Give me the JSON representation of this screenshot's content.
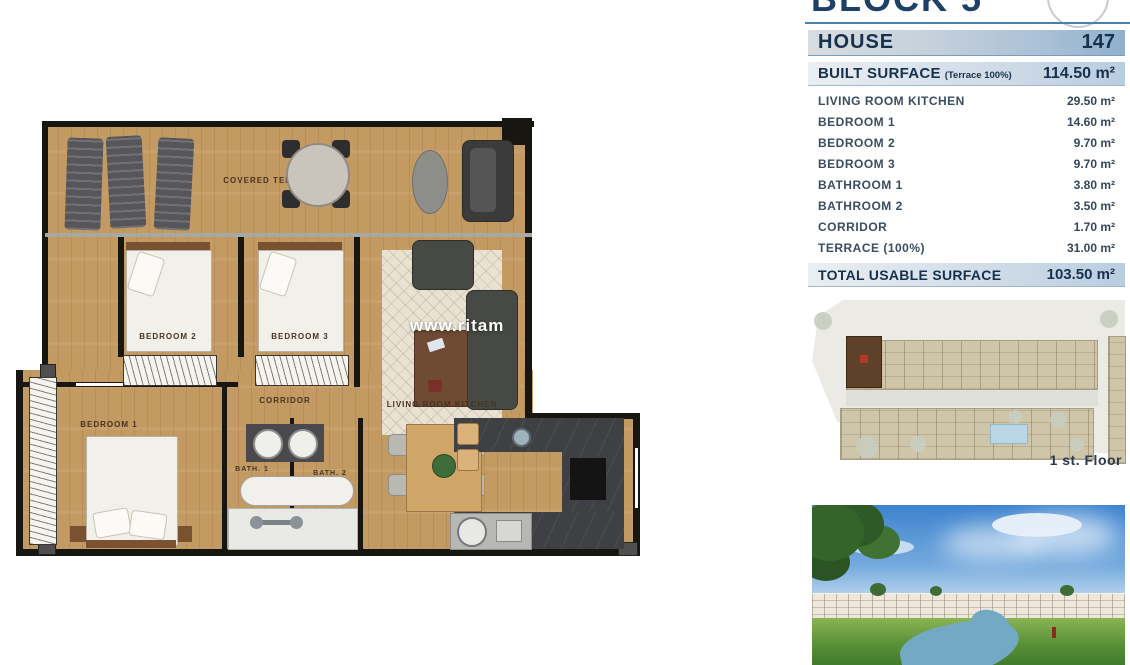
{
  "document": {
    "block_title": "BLOCK 5"
  },
  "spec": {
    "house_label": "HOUSE",
    "house_number": "147",
    "built_surface_label": "BUILT SURFACE",
    "built_surface_note": "(Terrace 100%)",
    "built_surface_value": "114.50 m²",
    "rooms": [
      {
        "label": "LIVING ROOM KITCHEN",
        "value": "29.50 m²"
      },
      {
        "label": "BEDROOM 1",
        "value": "14.60 m²"
      },
      {
        "label": "BEDROOM 2",
        "value": "9.70 m²"
      },
      {
        "label": "BEDROOM 3",
        "value": "9.70 m²"
      },
      {
        "label": "BATHROOM 1",
        "value": "3.80 m²"
      },
      {
        "label": "BATHROOM 2",
        "value": "3.50 m²"
      },
      {
        "label": "CORRIDOR",
        "value": "1.70 m²"
      },
      {
        "label": "TERRACE (100%)",
        "value": "31.00 m²"
      }
    ],
    "total_label": "TOTAL USABLE SURFACE",
    "total_value": "103.50 m²"
  },
  "site_plan": {
    "floor_label": "1 st. Floor"
  },
  "floor_plan": {
    "watermark": "www.ritam",
    "labels": {
      "covered_terrace": "COVERED TERRACE",
      "bedroom1": "BEDROOM 1",
      "bedroom2": "BEDROOM 2",
      "bedroom3": "BEDROOM 3",
      "corridor": "CORRIDOR",
      "living_room_kitchen": "LIVING ROOM KITCHEN",
      "bath1": "BATH. 1",
      "bath2": "BATH. 2"
    }
  },
  "colors": {
    "accent_navy": "#16314d",
    "bar_gradient_start": "#d8dcdf",
    "bar_gradient_end": "#8fb0cc",
    "wood": "#c49a63",
    "wall": "#171610",
    "highlighted_unit": "#5e4128",
    "pool": "#b9d6e6"
  }
}
